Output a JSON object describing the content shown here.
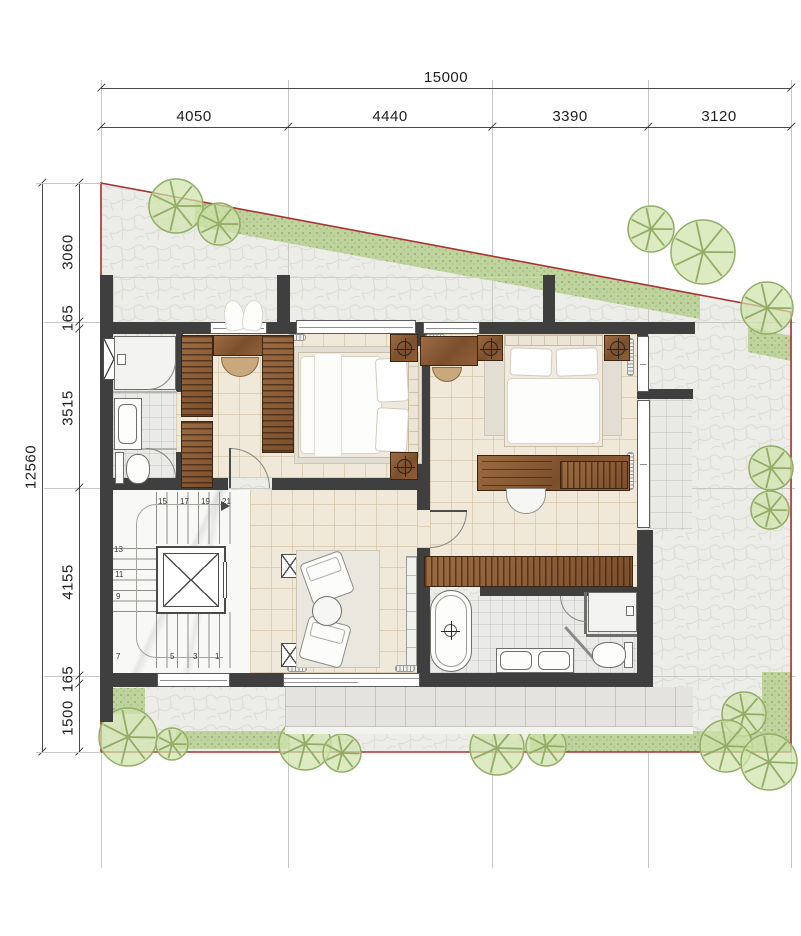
{
  "drawing": {
    "type": "architectural-floor-plan",
    "dimensions_top": {
      "total": "15000",
      "segments": [
        "4050",
        "4440",
        "3390",
        "3120"
      ]
    },
    "dimensions_left": {
      "total": "12560",
      "segments": [
        "3060",
        "165",
        "3515",
        "4155",
        "165",
        "1500"
      ]
    },
    "stairs": {
      "numbers": [
        "15",
        "17",
        "19",
        "21",
        "13",
        "11",
        "9",
        "7",
        "5",
        "3",
        "1"
      ]
    },
    "colors": {
      "wall": "#3f3f3f",
      "boundary": "#a83434",
      "wood": "#8a5c38",
      "floor_tile": "#f0e9da",
      "paving": "#ecede8",
      "hedge": "#bdd29b",
      "tree_fill": "#cfe3ab",
      "tree_stroke": "#93ad66",
      "marble": "#f8f8f6",
      "balcony_tile": "#e4e3df",
      "grid_line": "#c8c8c4",
      "dimension_text": "#1d1d1d"
    },
    "landscape": {
      "trees": [
        {
          "x": 176,
          "y": 206,
          "r": 27
        },
        {
          "x": 219,
          "y": 224,
          "r": 21
        },
        {
          "x": 651,
          "y": 229,
          "r": 23
        },
        {
          "x": 703,
          "y": 252,
          "r": 32
        },
        {
          "x": 767,
          "y": 308,
          "r": 26
        },
        {
          "x": 771,
          "y": 468,
          "r": 22
        },
        {
          "x": 770,
          "y": 510,
          "r": 19
        },
        {
          "x": 128,
          "y": 737,
          "r": 29
        },
        {
          "x": 172,
          "y": 744,
          "r": 16
        },
        {
          "x": 305,
          "y": 744,
          "r": 26
        },
        {
          "x": 342,
          "y": 753,
          "r": 19
        },
        {
          "x": 497,
          "y": 748,
          "r": 27
        },
        {
          "x": 546,
          "y": 746,
          "r": 20
        },
        {
          "x": 744,
          "y": 714,
          "r": 22
        },
        {
          "x": 726,
          "y": 746,
          "r": 26
        },
        {
          "x": 769,
          "y": 762,
          "r": 28
        }
      ]
    }
  }
}
